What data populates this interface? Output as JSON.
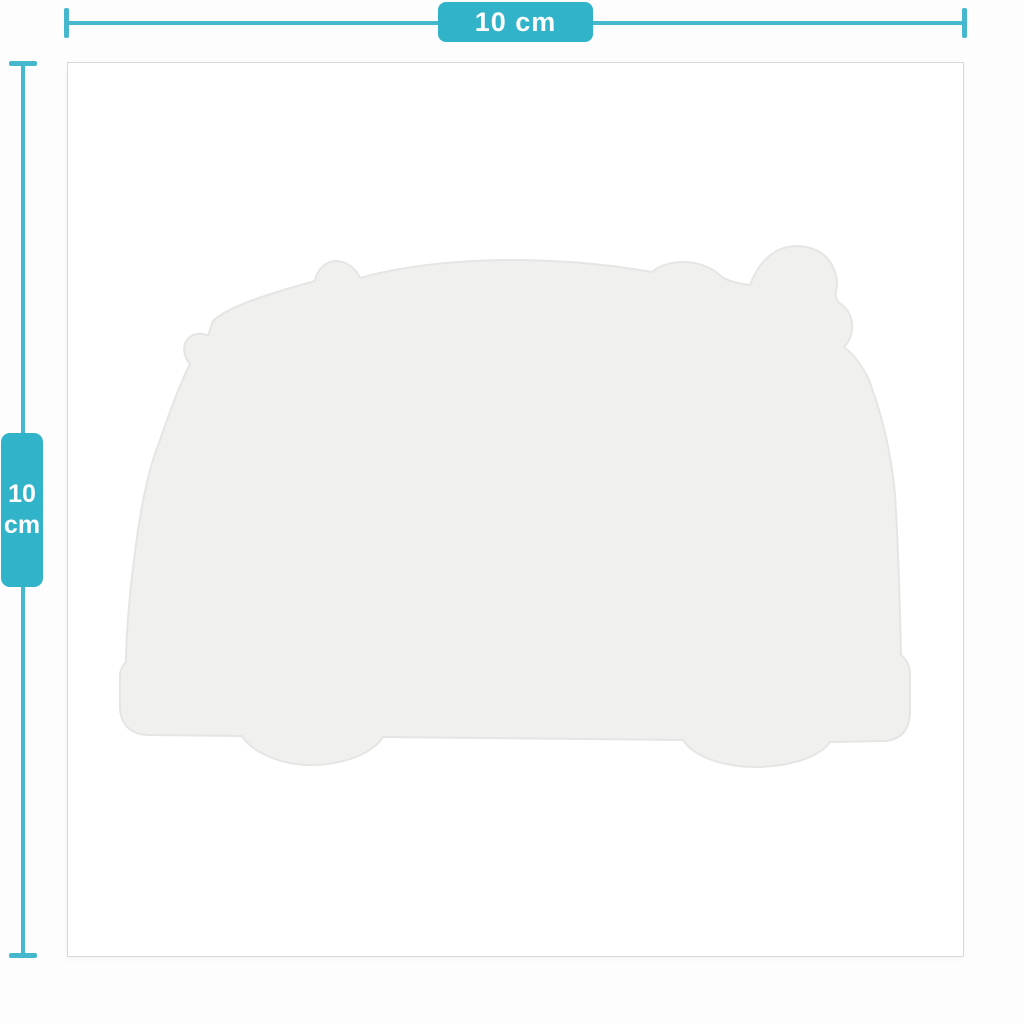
{
  "colors": {
    "accent": "#31b3c9",
    "ruler": "#46b8cd",
    "label_text": "#ffffff",
    "card_background": "#ffffff",
    "card_border": "#d9d9d9",
    "canvas_background": "#fdfdfd",
    "silhouette_fill": "#f0f0ee",
    "silhouette_stroke": "#e5e5e3"
  },
  "width_dimension": {
    "label": "10 cm"
  },
  "height_dimension": {
    "value": "10",
    "unit": "cm"
  },
  "icons": {
    "product": "camper-van-silhouette"
  }
}
